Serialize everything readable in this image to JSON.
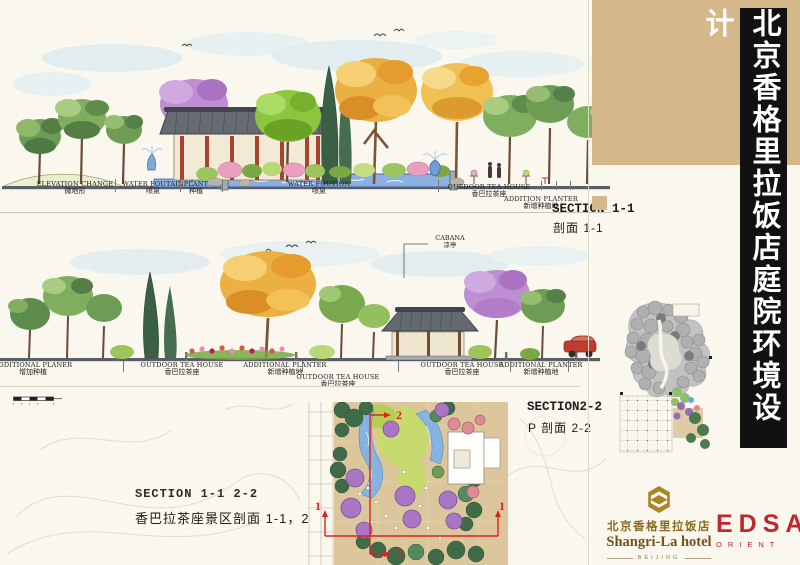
{
  "page": {
    "title": "北京香格里拉饭店庭院环境设计"
  },
  "sections": {
    "s1": {
      "name": "SECTION 1-1",
      "name_cn": "剖面 1-1",
      "labels": [
        {
          "en": "ELEVATION CHANGE",
          "cn": "微地形"
        },
        {
          "en": "WATER FOUTAIN",
          "cn": "喷泉"
        },
        {
          "en": "PLANT",
          "cn": "种植"
        },
        {
          "en": "WATER FOUTION",
          "cn": "喷泉"
        },
        {
          "en": "OUTDOOR TEA HOUSE",
          "cn": "香巴拉茶座"
        },
        {
          "en": "ADDITION PLANTER",
          "cn": "新增种植地"
        }
      ]
    },
    "s2": {
      "name": "SECTION2-2",
      "name_cn": "P 剖面 2-2",
      "cabana_en": "CABANA",
      "cabana_cn": "凉亭",
      "labels": [
        {
          "en": "ADDITIONAL PLANER",
          "cn": "增加种植"
        },
        {
          "en": "OUTDOOR TEA HOUSE",
          "cn": "香巴拉茶座"
        },
        {
          "en": "ADDITIONAL PLANTER",
          "cn": "新增种植地"
        },
        {
          "en": "OUTDOOR TEA HOUSE",
          "cn": "香巴拉茶座"
        },
        {
          "en": "OUTDOOR TEA HOUSE",
          "cn": "香巴拉茶座"
        },
        {
          "en": "ADDITIONAL PLANTER",
          "cn": "新增种植地"
        }
      ]
    }
  },
  "caption": {
    "en": "SECTION 1-1 2-2",
    "cn": "香巴拉茶座景区剖面 1-1，2-2"
  },
  "plan_markers": {
    "m1": "1",
    "m2": "2"
  },
  "logos": {
    "shangrila": {
      "cn": "北京香格里拉饭店",
      "en": "Shangri-La hotel",
      "city": "BEIJING"
    },
    "edsa": {
      "name": "EDSA",
      "sub": "ORIENT"
    }
  },
  "colors": {
    "sidebar_tan": "#d5b88a",
    "title_bg": "#111111",
    "title_fg": "#ffffff",
    "edsa_red": "#c1272d",
    "shangrila_gold": "#ab8526",
    "section_line_red": "#e02020"
  }
}
